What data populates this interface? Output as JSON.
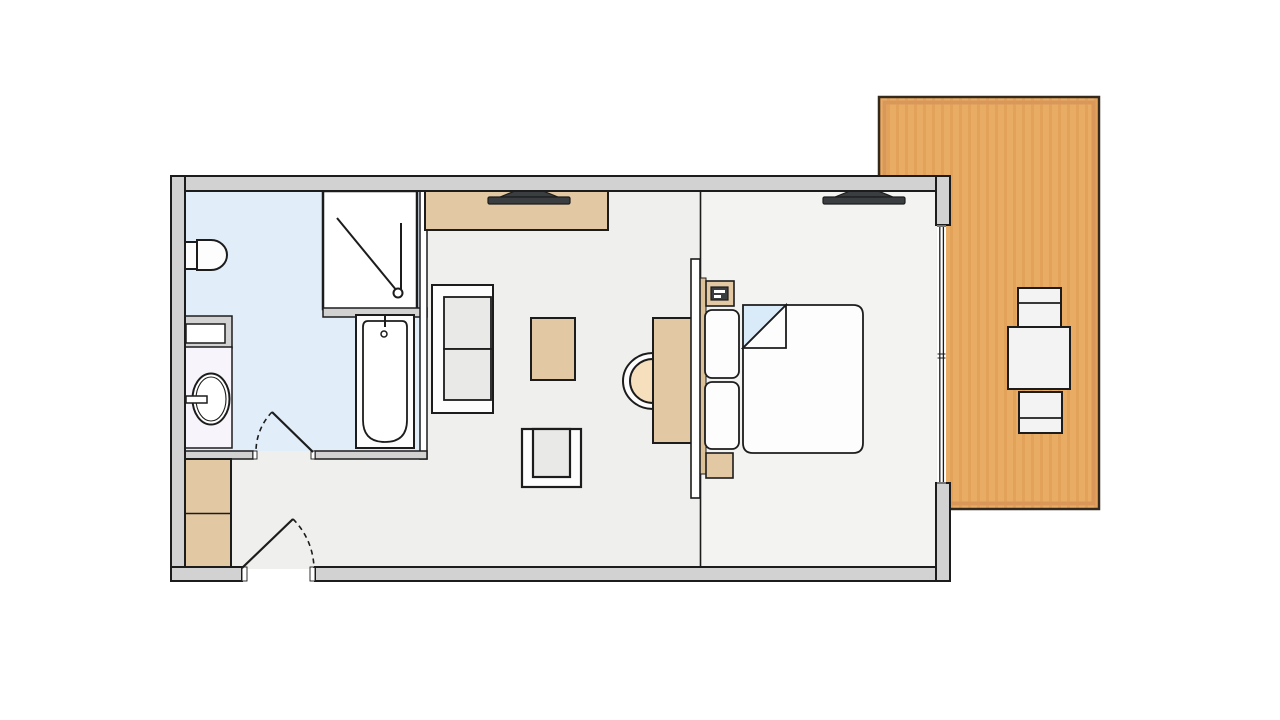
{
  "diagram": {
    "type": "architectural-floor-plan",
    "description": "Top-view floor plan of a one-bedroom suite with bathroom, living area, bedroom and an adjoining wooden terrace",
    "rooms": [
      "bathroom",
      "living-area",
      "bedroom",
      "terrace"
    ],
    "furniture_icons": [
      "toilet-icon",
      "shower-icon",
      "bathtub-icon",
      "sink-vanity-icon",
      "shelf-icon",
      "wardrobe-icon",
      "entrance-door-icon",
      "bathroom-door-icon",
      "sideboard-icon",
      "tv-icon",
      "sofa-icon",
      "coffee-table-icon",
      "armchair-icon",
      "desk-icon",
      "desk-chair-icon",
      "headboard-partition-icon",
      "nightstand-icon",
      "telephone-icon",
      "pillow-icon",
      "double-bed-icon",
      "window-icon",
      "terrace-deck-icon",
      "outdoor-table-icon",
      "outdoor-chair-icon"
    ]
  },
  "colors": {
    "background": "#ffffff",
    "wall_fill": "#d2d2d2",
    "line": "#1c1c1c",
    "floor_living": "#eff0ee",
    "floor_bedroom": "#f3f3f2",
    "floor_bathroom": "#e2edfa",
    "fixture_white": "#fdfdfd",
    "vanity_fill": "#f7f5fb",
    "wood_tan": "#e3c9a3",
    "wood_strip": "#dcc197",
    "seat_tan": "#f6dfbd",
    "cushion_gray": "#e9eae8",
    "tv_dark": "#3b3e41",
    "terrace_fill": "#e9ac64",
    "terrace_stripe": "#e2a259",
    "terrace_frame": "#d9985a",
    "terrace_outline": "#33291d",
    "terrace_furniture": "#f3f3f3",
    "sheet_blue": "#d9eaf9"
  }
}
